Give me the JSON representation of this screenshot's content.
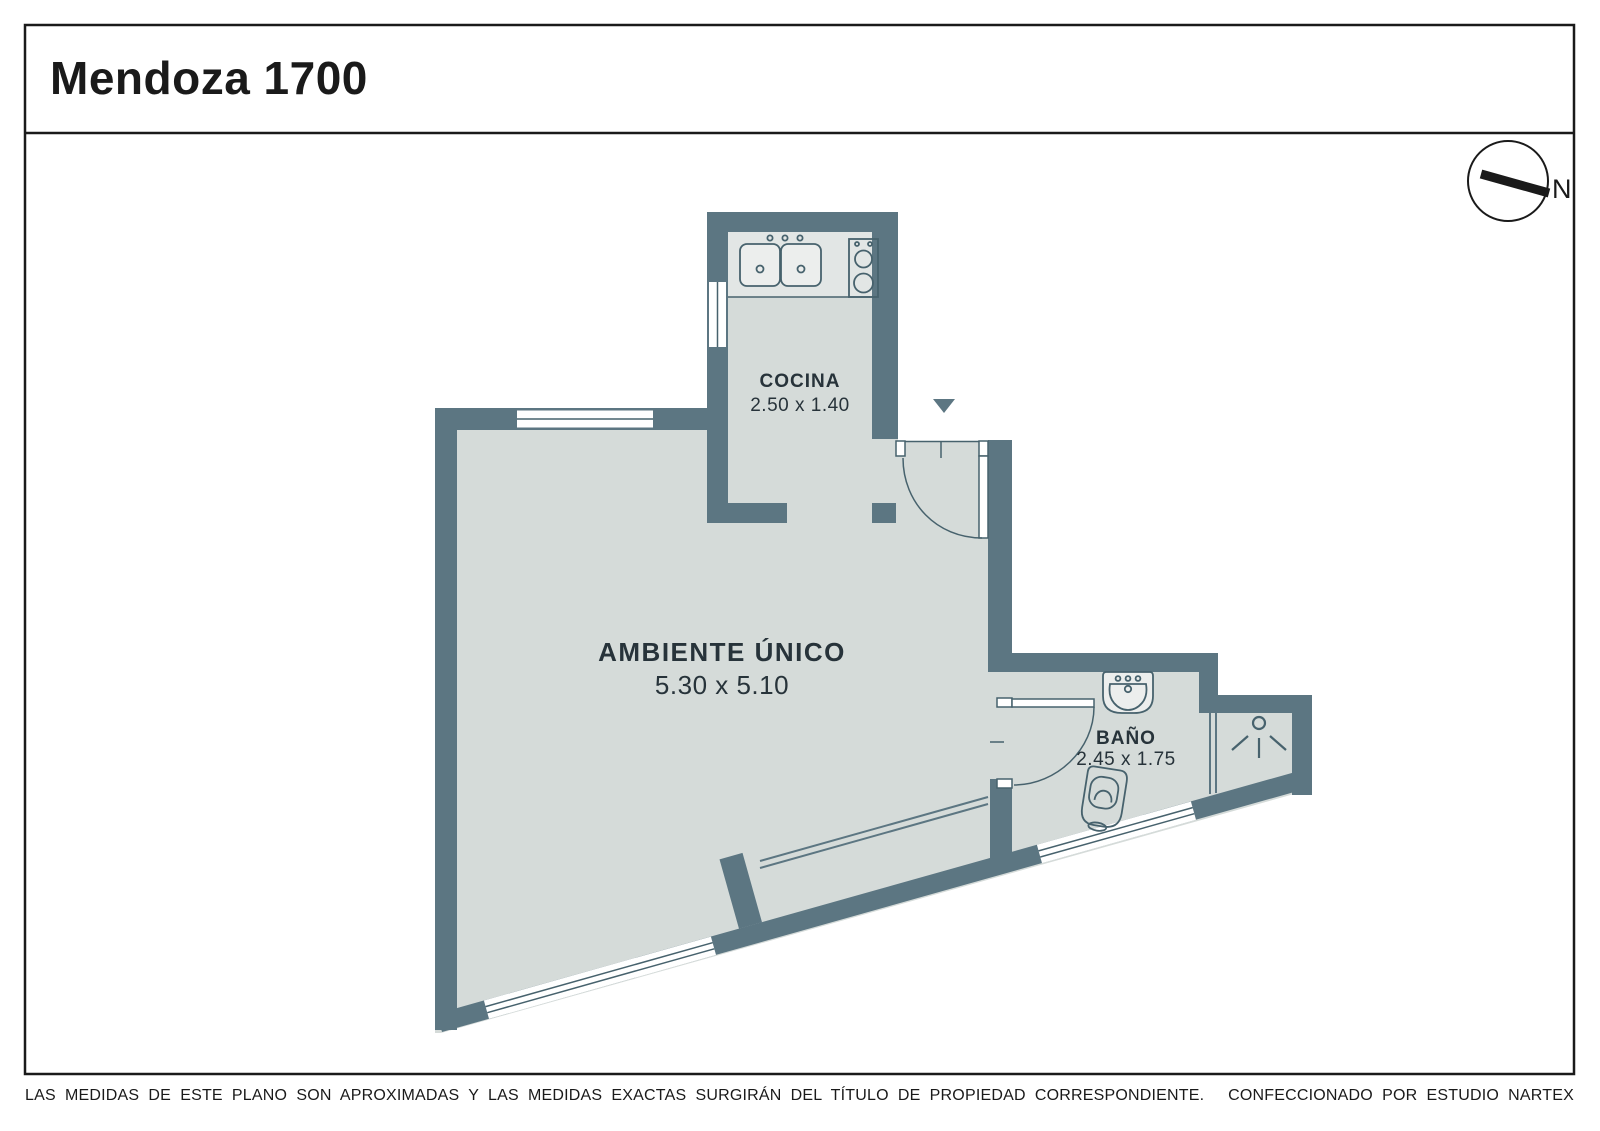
{
  "title": "Mendoza 1700",
  "compass": {
    "label": "N"
  },
  "rooms": {
    "main": {
      "name": "AMBIENTE ÚNICO",
      "dims": "5.30 x 5.10"
    },
    "kitchen": {
      "name": "COCINA",
      "dims": "2.50 x 1.40"
    },
    "bath": {
      "name": "BAÑO",
      "dims": "2.45 x 1.75"
    }
  },
  "footer": {
    "left": "LAS MEDIDAS  DE ESTE PLANO SON APROXIMADAS Y LAS MEDIDAS EXACTAS SURGIRÁN DEL TÍTULO DE PROPIEDAD CORRESPONDIENTE.",
    "right": "CONFECCIONADO POR ESTUDIO NARTEX"
  },
  "colors": {
    "wall": "#5c7682",
    "floor": "#d5dbd9",
    "counter": "#e2e6e5",
    "fixture": "#eceeed",
    "fixture_line": "#47626d",
    "exterior": "#ffffff",
    "ink": "#1a1a1a",
    "label": "#27333a"
  }
}
